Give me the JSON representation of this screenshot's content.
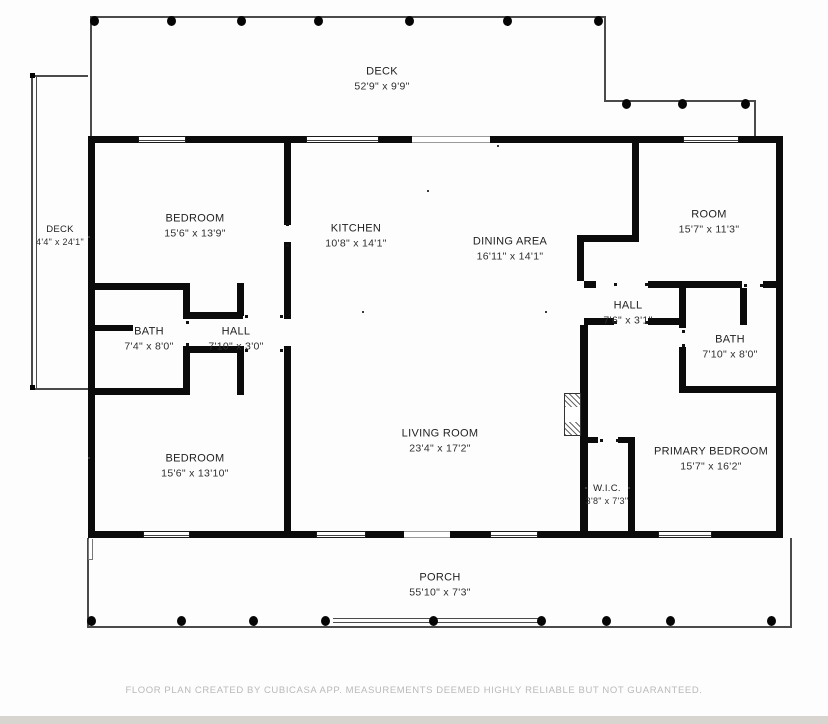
{
  "footer": {
    "text": "FLOOR PLAN CREATED BY CUBICASA APP. MEASUREMENTS DEEMED HIGHLY RELIABLE BUT NOT GUARANTEED."
  },
  "colors": {
    "wall": "#0b0b0b",
    "outline": "#4a4a4a",
    "label_text": "#222222",
    "footer_text": "#b9b9b9",
    "bottom_strip": "#d8d5d0"
  },
  "rooms": [
    {
      "name": "DECK",
      "dims": "52'9\" x 9'9\"",
      "cx": 382,
      "cy": 79,
      "small": false
    },
    {
      "name": "DECK",
      "dims": "4'4\" x 24'1\"",
      "cx": 60,
      "cy": 236,
      "small": true
    },
    {
      "name": "BEDROOM",
      "dims": "15'6\" x 13'9\"",
      "cx": 195,
      "cy": 226,
      "small": false
    },
    {
      "name": "KITCHEN",
      "dims": "10'8\" x 14'1\"",
      "cx": 356,
      "cy": 236,
      "small": false
    },
    {
      "name": "DINING AREA",
      "dims": "16'11\" x 14'1\"",
      "cx": 510,
      "cy": 249,
      "small": false
    },
    {
      "name": "ROOM",
      "dims": "15'7\" x 11'3\"",
      "cx": 709,
      "cy": 222,
      "small": false
    },
    {
      "name": "BATH",
      "dims": "7'4\" x 8'0\"",
      "cx": 149,
      "cy": 339,
      "small": false
    },
    {
      "name": "HALL",
      "dims": "7'10\" x 3'0\"",
      "cx": 236,
      "cy": 339,
      "small": false
    },
    {
      "name": "HALL",
      "dims": "7'6\" x 3'1\"",
      "cx": 628,
      "cy": 313,
      "small": false
    },
    {
      "name": "BATH",
      "dims": "7'10\" x 8'0\"",
      "cx": 730,
      "cy": 347,
      "small": false
    },
    {
      "name": "BEDROOM",
      "dims": "15'6\" x 13'10\"",
      "cx": 195,
      "cy": 466,
      "small": false
    },
    {
      "name": "LIVING ROOM",
      "dims": "23'4\" x 17'2\"",
      "cx": 440,
      "cy": 441,
      "small": false
    },
    {
      "name": "PRIMARY BEDROOM",
      "dims": "15'7\" x 16'2\"",
      "cx": 711,
      "cy": 459,
      "small": false
    },
    {
      "name": "W.I.C.",
      "dims": "3'8\" x 7'3\"",
      "cx": 607,
      "cy": 495,
      "small": true
    },
    {
      "name": "PORCH",
      "dims": "55'10\" x 7'3\"",
      "cx": 440,
      "cy": 585,
      "small": false
    }
  ],
  "deck_top_posts_x": [
    94,
    171,
    241,
    318,
    409,
    507,
    598
  ],
  "deck_top_lower_posts_x": [
    626,
    682,
    745
  ],
  "porch_posts_x": [
    91,
    181,
    253,
    325,
    433,
    541,
    606,
    670,
    771
  ]
}
